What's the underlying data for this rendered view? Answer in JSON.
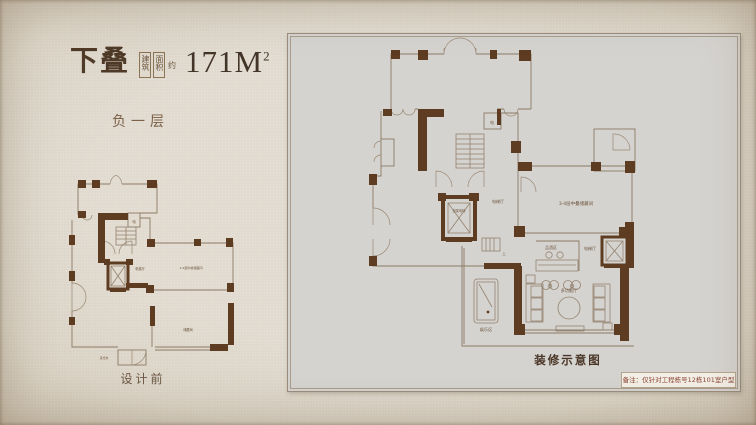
{
  "title": {
    "product": "下叠",
    "area_box": [
      "建筑",
      "面积"
    ],
    "area_approx": "约",
    "area_value": "171M",
    "area_sup": "2"
  },
  "subtitle": "负一层",
  "left_plan": {
    "caption": "设计前",
    "labels": {
      "electric": "电",
      "elevator_hall": "电梯厅",
      "mid_storage": "3-4层中叠储藏间",
      "storage": "储藏间",
      "lightwell": "采光井"
    }
  },
  "right_plan": {
    "caption": "装修示意图",
    "labels": {
      "electric": "电",
      "up": "上",
      "elevator": "担架电梯",
      "elevator_hall_left": "电梯厅",
      "elevator_hall_right": "电梯厅",
      "mid_storage": "3-4层中叠储藏间",
      "wine": "品酒区",
      "hall": "多功能厅",
      "recreation": "娱乐区"
    }
  },
  "note": "备注：仅针对工程栋号12栋101室户型",
  "colors": {
    "background": "#e2dcd2",
    "panel": "#d5d3d0",
    "wall_pier": "#5e3c21",
    "wall_line": "#8d7a64",
    "title_text": "#4e3a27",
    "subtitle_text": "#7c6047",
    "note_text": "#8a4233"
  }
}
